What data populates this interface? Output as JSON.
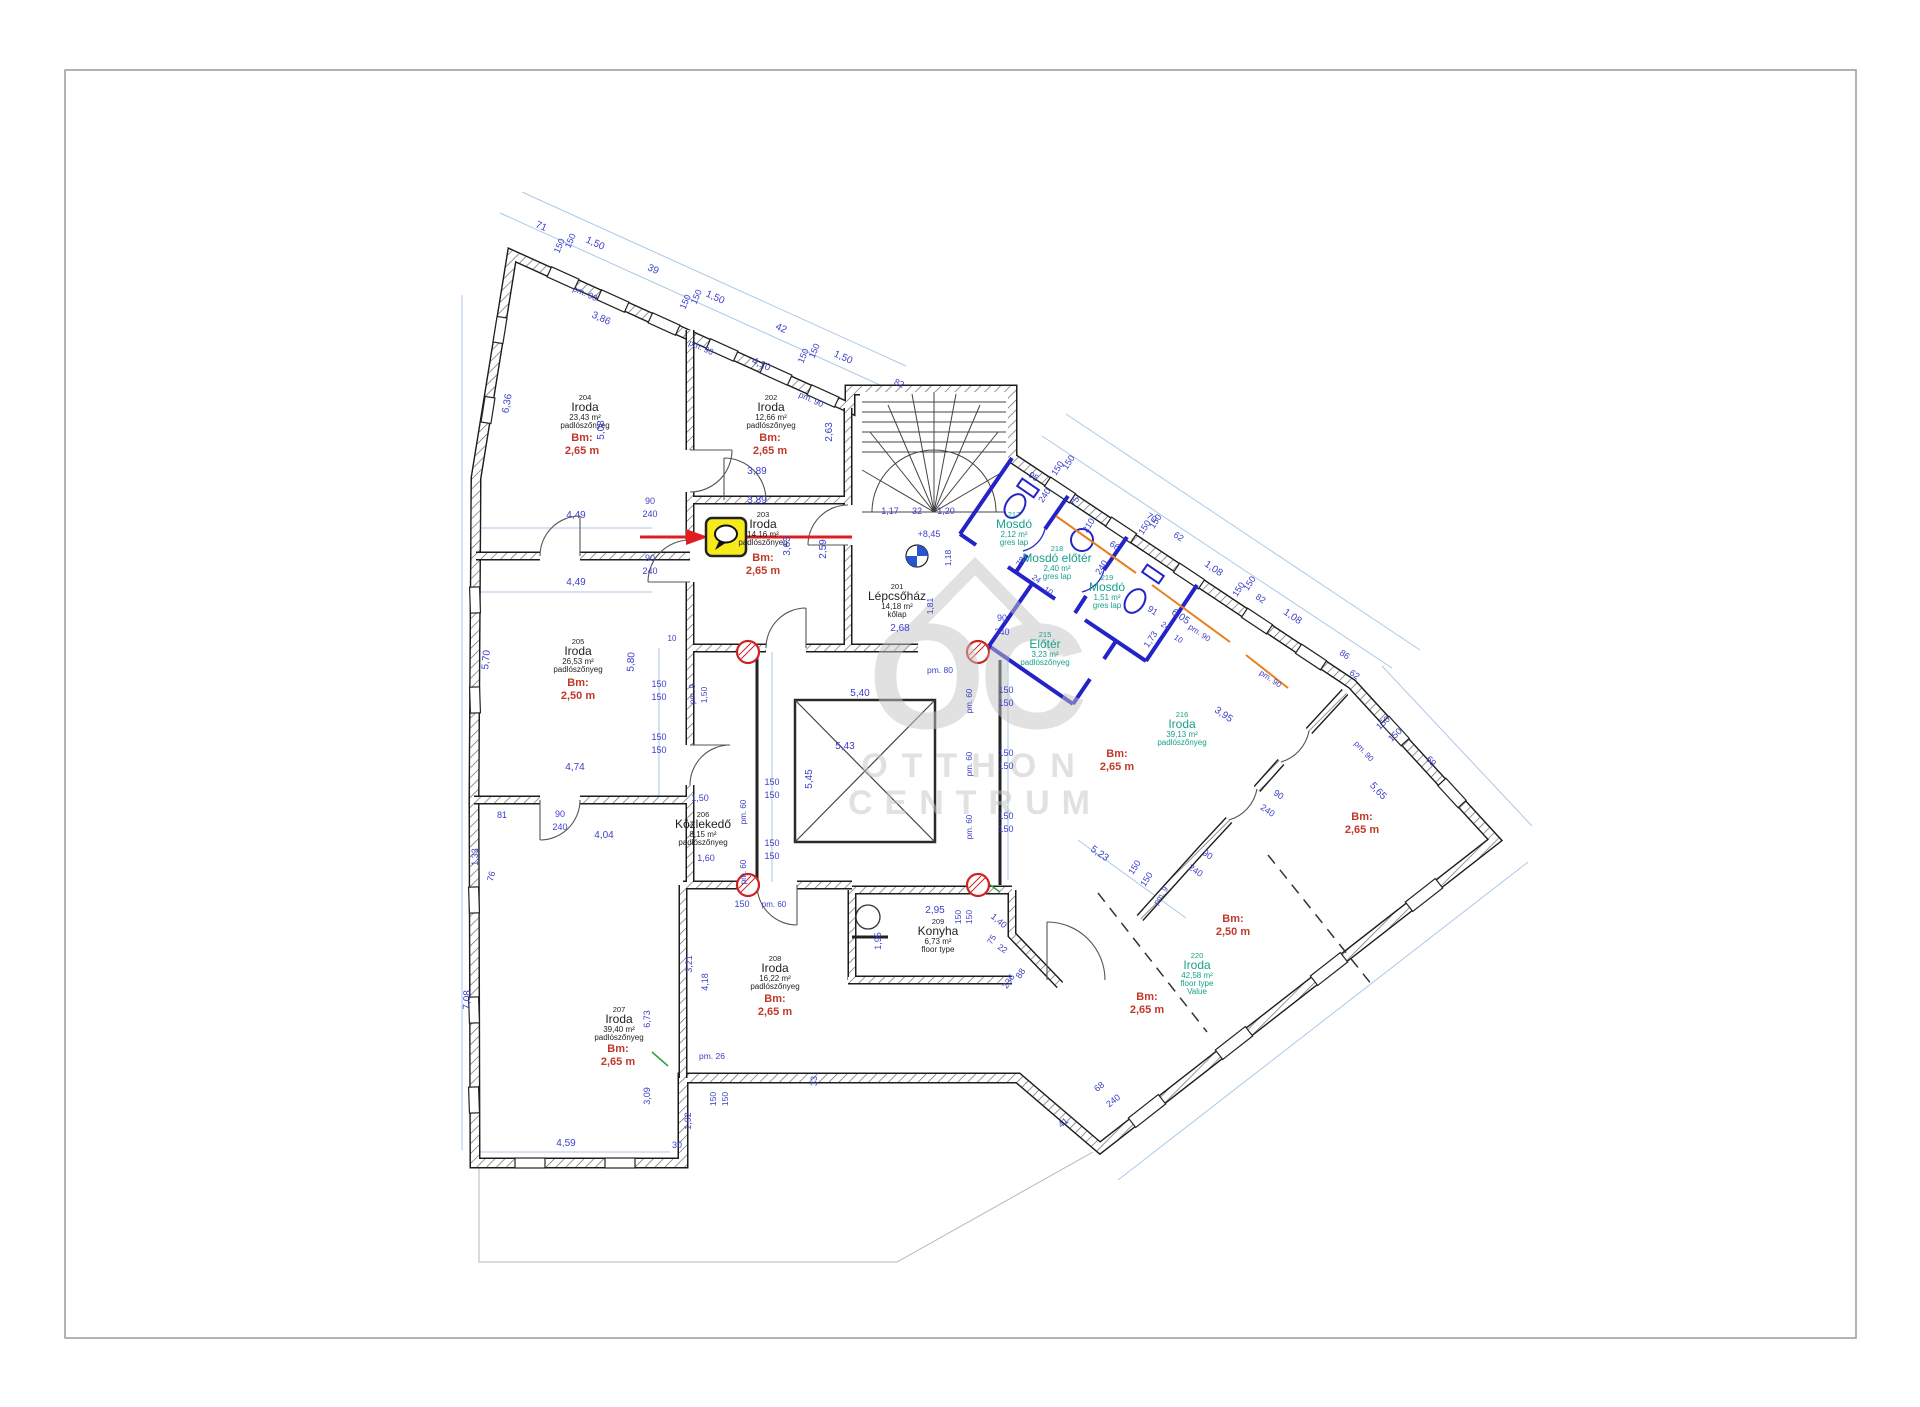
{
  "page": {
    "width": 1920,
    "height": 1407
  },
  "colors": {
    "dim": "#3a3fc8",
    "dimline": "#a9c9e9",
    "teal": "#18a08c",
    "bm_red": "#c0392b",
    "wall": "#1d1d1d",
    "blue_wall": "#2323c8",
    "orange": "#e8801e",
    "marker_yellow": "#f7ea1a",
    "red_line": "#e11b22",
    "watermark_gray": "#c5c5c5"
  },
  "watermark": {
    "oc": "OC",
    "otthon": "OTTHON",
    "centrum": "CENTRUM"
  },
  "marker": {
    "icon": "speech-bubble"
  },
  "stair_symbol_level": "+8,45",
  "rooms": [
    {
      "x": 897,
      "y": 589,
      "num": "201",
      "name": "Lépcsőház",
      "area": "14,18 m²",
      "floor": "kőlap",
      "teal": false
    },
    {
      "x": 771,
      "y": 400,
      "num": "202",
      "name": "Iroda",
      "area": "12,66 m²",
      "floor": "padlószőnyeg",
      "teal": false,
      "bm": "2,65 m",
      "bx": 770,
      "by": 441
    },
    {
      "x": 763,
      "y": 517,
      "num": "203",
      "name": "Iroda",
      "area": "14,16 m²",
      "floor": "padlószőnyeg",
      "teal": false,
      "bm": "2,65 m",
      "bx": 763,
      "by": 561
    },
    {
      "x": 585,
      "y": 400,
      "num": "204",
      "name": "Iroda",
      "area": "23,43 m²",
      "floor": "padlószőnyeg",
      "teal": false,
      "bm": "2,65 m",
      "bx": 582,
      "by": 441
    },
    {
      "x": 578,
      "y": 644,
      "num": "205",
      "name": "Iroda",
      "area": "26,53 m²",
      "floor": "padlószőnyeg",
      "teal": false,
      "bm": "2,50 m",
      "bx": 578,
      "by": 686
    },
    {
      "x": 703,
      "y": 817,
      "num": "206",
      "name": "Közlekedő",
      "area": "8,15 m²",
      "floor": "padlószőnyeg",
      "teal": false
    },
    {
      "x": 619,
      "y": 1012,
      "num": "207",
      "name": "Iroda",
      "area": "39,40 m²",
      "floor": "padlószőnyeg",
      "teal": false,
      "bm": "2,65 m",
      "bx": 618,
      "by": 1052
    },
    {
      "x": 775,
      "y": 961,
      "num": "208",
      "name": "Iroda",
      "area": "16,22 m²",
      "floor": "padlószőnyeg",
      "teal": false,
      "bm": "2,65 m",
      "bx": 775,
      "by": 1002
    },
    {
      "x": 938,
      "y": 924,
      "num": "209",
      "name": "Konyha",
      "area": "6,73 m²",
      "floor": "floor type",
      "teal": false
    },
    {
      "x": 1045,
      "y": 637,
      "num": "215",
      "name": "Előtér",
      "area": "3,23 m²",
      "floor": "padlószőnyeg",
      "teal": true
    },
    {
      "x": 1182,
      "y": 717,
      "num": "216",
      "name": "Iroda",
      "area": "39,13 m²",
      "floor": "padlószőnyeg",
      "teal": true
    },
    {
      "x": 1014,
      "y": 517,
      "num": "217",
      "name": "Mosdó",
      "area": "2,12 m²",
      "floor": "gres lap",
      "teal": true
    },
    {
      "x": 1057,
      "y": 551,
      "num": "218",
      "name": "Mosdó előtér",
      "area": "2,40 m²",
      "floor": "gres lap",
      "teal": true
    },
    {
      "x": 1107,
      "y": 580,
      "num": "219",
      "name": "Mosdó",
      "area": "1,51 m²",
      "floor": "gres lap",
      "teal": true
    },
    {
      "x": 1197,
      "y": 958,
      "num": "220",
      "name": "Iroda",
      "area": "42,58 m²",
      "floor": "floor type",
      "extra": "Value",
      "teal": true
    }
  ],
  "bm_labels": [
    {
      "x": 1117,
      "y": 757,
      "v": "2,65 m"
    },
    {
      "x": 1362,
      "y": 820,
      "v": "2,65 m"
    },
    {
      "x": 1233,
      "y": 922,
      "v": "2,50 m"
    },
    {
      "x": 1147,
      "y": 1000,
      "v": "2,65 m"
    }
  ],
  "dims": [
    [
      540,
      229,
      24,
      "71"
    ],
    [
      594,
      246,
      24,
      "1,50"
    ],
    [
      652,
      272,
      24,
      "39"
    ],
    [
      714,
      300,
      24,
      "1,50"
    ],
    [
      780,
      331,
      24,
      "42"
    ],
    [
      842,
      360,
      24,
      "1,50"
    ],
    [
      898,
      386,
      24,
      "82",
      9
    ],
    [
      562,
      247,
      -66,
      "150",
      9
    ],
    [
      573,
      242,
      -66,
      "150",
      9
    ],
    [
      688,
      303,
      -66,
      "150",
      9
    ],
    [
      699,
      298,
      -66,
      "150",
      9
    ],
    [
      806,
      357,
      -66,
      "150",
      9
    ],
    [
      817,
      352,
      -66,
      "150",
      9
    ],
    [
      584,
      296,
      24,
      "pm. 90",
      8.5
    ],
    [
      700,
      350,
      24,
      "pm. 90",
      8.5
    ],
    [
      810,
      402,
      24,
      "pm. 90",
      8.5
    ],
    [
      600,
      321,
      24,
      "3,86"
    ],
    [
      760,
      367,
      24,
      "4,10"
    ],
    [
      510,
      404,
      -80,
      "6,36"
    ],
    [
      604,
      430,
      -90,
      "5,08"
    ],
    [
      832,
      432,
      -90,
      "2,63"
    ],
    [
      757,
      474,
      0,
      "3,89"
    ],
    [
      757,
      503,
      0,
      "3,89"
    ],
    [
      650,
      504,
      0,
      "90",
      9
    ],
    [
      650,
      517,
      0,
      "240",
      9
    ],
    [
      650,
      561,
      0,
      "90",
      9
    ],
    [
      650,
      574,
      0,
      "240",
      9
    ],
    [
      576,
      518,
      0,
      "4,49"
    ],
    [
      576,
      585,
      0,
      "4,49"
    ],
    [
      489,
      660,
      -85,
      "5,70"
    ],
    [
      634,
      662,
      -87,
      "5,80"
    ],
    [
      470,
      1000,
      -88,
      "7,08"
    ],
    [
      659,
      687,
      0,
      "150",
      9
    ],
    [
      659,
      700,
      0,
      "150",
      9
    ],
    [
      659,
      740,
      0,
      "150",
      9
    ],
    [
      659,
      753,
      0,
      "150",
      9
    ],
    [
      695,
      694,
      -90,
      "pm. 9",
      8
    ],
    [
      707,
      695,
      -90,
      "1,50",
      8.5
    ],
    [
      672,
      641,
      0,
      "10",
      8
    ],
    [
      575,
      770,
      0,
      "4,74"
    ],
    [
      604,
      838,
      0,
      "4,04"
    ],
    [
      502,
      818,
      0,
      "81",
      9
    ],
    [
      478,
      857,
      -90,
      "1,33",
      9
    ],
    [
      494,
      877,
      -75,
      "76",
      9
    ],
    [
      700,
      801,
      0,
      "1,50",
      9
    ],
    [
      706,
      861,
      0,
      "1,60",
      9
    ],
    [
      772,
      785,
      0,
      "150",
      9
    ],
    [
      772,
      798,
      0,
      "150",
      9
    ],
    [
      772,
      846,
      0,
      "150",
      9
    ],
    [
      772,
      859,
      0,
      "150",
      9
    ],
    [
      746,
      812,
      -90,
      "pm. 60",
      8
    ],
    [
      746,
      872,
      -90,
      "pm. 60",
      8
    ],
    [
      742,
      907,
      0,
      "150",
      9
    ],
    [
      774,
      907,
      0,
      "pm. 60",
      8
    ],
    [
      940,
      673,
      0,
      "pm. 80",
      8.5
    ],
    [
      860,
      696,
      0,
      "5,40"
    ],
    [
      900,
      631,
      0,
      "2,68"
    ],
    [
      845,
      749,
      0,
      "5,43"
    ],
    [
      812,
      779,
      -90,
      "5,45"
    ],
    [
      1006,
      693,
      0,
      "150",
      9
    ],
    [
      1006,
      706,
      0,
      "150",
      9
    ],
    [
      1006,
      756,
      0,
      "150",
      9
    ],
    [
      1006,
      769,
      0,
      "150",
      9
    ],
    [
      1006,
      819,
      0,
      "150",
      9
    ],
    [
      1006,
      832,
      0,
      "150",
      9
    ],
    [
      972,
      701,
      -90,
      "pm. 60",
      8
    ],
    [
      972,
      764,
      -90,
      "pm. 60",
      8
    ],
    [
      972,
      827,
      -90,
      "pm. 60",
      8
    ],
    [
      1002,
      621,
      0,
      "90",
      9
    ],
    [
      1002,
      635,
      0,
      "240",
      9
    ],
    [
      790,
      546,
      -90,
      "3,63"
    ],
    [
      826,
      549,
      -90,
      "2,59"
    ],
    [
      890,
      514,
      0,
      "1,17",
      9
    ],
    [
      917,
      514,
      0,
      "32",
      9
    ],
    [
      946,
      514,
      0,
      "1,20",
      9
    ],
    [
      929,
      537,
      0,
      "+8,45",
      9
    ],
    [
      951,
      558,
      -90,
      "1,18",
      8.5
    ],
    [
      933,
      606,
      -90,
      "1,81",
      8.5
    ],
    [
      1032,
      479,
      34,
      "95",
      9
    ],
    [
      1047,
      497,
      -57,
      "240",
      9
    ],
    [
      1077,
      503,
      -57,
      "75",
      9
    ],
    [
      1091,
      527,
      -57,
      "210",
      9
    ],
    [
      1113,
      548,
      34,
      "66",
      9
    ],
    [
      1104,
      569,
      -57,
      "240",
      9
    ],
    [
      1023,
      563,
      -57,
      "78",
      8.5
    ],
    [
      1035,
      581,
      34,
      "24",
      8
    ],
    [
      1047,
      593,
      34,
      "10",
      8
    ],
    [
      1151,
      613,
      34,
      "91",
      9
    ],
    [
      1164,
      628,
      34,
      "24",
      8
    ],
    [
      1177,
      641,
      34,
      "10",
      8
    ],
    [
      1060,
      470,
      -57,
      "150",
      9
    ],
    [
      1071,
      464,
      -57,
      "150",
      9
    ],
    [
      1147,
      529,
      -57,
      "150",
      9
    ],
    [
      1158,
      523,
      -57,
      "150",
      9
    ],
    [
      1241,
      591,
      -57,
      "150",
      9
    ],
    [
      1252,
      585,
      -57,
      "150",
      9
    ],
    [
      1150,
      520,
      34,
      "70",
      9
    ],
    [
      1177,
      539,
      34,
      "62",
      9
    ],
    [
      1212,
      571,
      34,
      "1,08"
    ],
    [
      1259,
      601,
      34,
      "82",
      9
    ],
    [
      1291,
      619,
      34,
      "1,08"
    ],
    [
      1343,
      657,
      34,
      "86",
      9
    ],
    [
      1353,
      677,
      34,
      "62",
      9
    ],
    [
      1198,
      635,
      34,
      "pm. 90",
      8
    ],
    [
      1269,
      681,
      34,
      "pm. 90",
      8
    ],
    [
      1179,
      619,
      34,
      "6,05"
    ],
    [
      1153,
      641,
      -57,
      "1,73",
      9
    ],
    [
      1385,
      725,
      -43,
      "150",
      9
    ],
    [
      1397,
      737,
      -43,
      "150",
      9
    ],
    [
      1362,
      753,
      47,
      "pm. 90",
      8
    ],
    [
      1429,
      763,
      47,
      "69",
      9
    ],
    [
      1376,
      793,
      47,
      "5,65"
    ],
    [
      1222,
      717,
      34,
      "3,95"
    ],
    [
      1098,
      856,
      34,
      "5,23"
    ],
    [
      1137,
      869,
      -57,
      "150",
      9
    ],
    [
      1149,
      881,
      -57,
      "150",
      9
    ],
    [
      1163,
      897,
      -57,
      "pm. 9",
      8
    ],
    [
      1277,
      797,
      34,
      "90",
      9
    ],
    [
      1266,
      813,
      34,
      "240",
      9
    ],
    [
      1206,
      857,
      34,
      "90",
      9
    ],
    [
      1194,
      873,
      34,
      "240",
      9
    ],
    [
      1101,
      1089,
      -38,
      "68",
      9
    ],
    [
      1115,
      1103,
      -38,
      "240",
      9
    ],
    [
      1065,
      1125,
      -38,
      "41",
      9
    ],
    [
      935,
      913,
      0,
      "2,95"
    ],
    [
      881,
      941,
      -90,
      "1,95",
      9
    ],
    [
      961,
      917,
      -90,
      "150",
      8.5
    ],
    [
      972,
      917,
      -90,
      "150",
      8.5
    ],
    [
      997,
      923,
      40,
      "1,40",
      9
    ],
    [
      994,
      941,
      -57,
      "75",
      8.5
    ],
    [
      1001,
      951,
      34,
      "22",
      8.5
    ],
    [
      1023,
      975,
      -57,
      "88",
      9
    ],
    [
      1011,
      983,
      -57,
      "236",
      9
    ],
    [
      712,
      1059,
      0,
      "pm. 26",
      8.5
    ],
    [
      716,
      1099,
      -90,
      "150",
      8.5
    ],
    [
      728,
      1099,
      -90,
      "150",
      8.5
    ],
    [
      691,
      1121,
      -90,
      "1,92",
      9
    ],
    [
      650,
      1096,
      -90,
      "3,09",
      9
    ],
    [
      677,
      1148,
      0,
      "30",
      9
    ],
    [
      566,
      1146,
      0,
      "4,59"
    ],
    [
      650,
      1019,
      -90,
      "6,73",
      9
    ],
    [
      692,
      964,
      -90,
      "3,21",
      9
    ],
    [
      708,
      982,
      -90,
      "4,18",
      9
    ],
    [
      817,
      1081,
      -90,
      "33",
      9
    ],
    [
      560,
      817,
      0,
      "90",
      9
    ],
    [
      560,
      830,
      0,
      "240",
      9
    ]
  ]
}
